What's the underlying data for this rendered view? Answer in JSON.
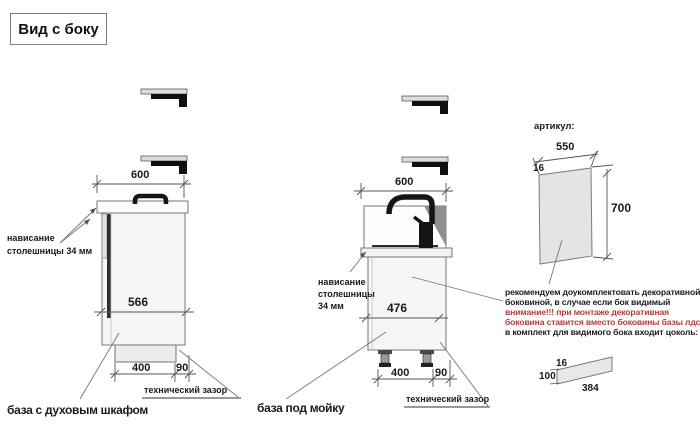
{
  "title": "Вид с боку",
  "colors": {
    "warning_text": "#b23b3b"
  },
  "oven_base": {
    "caption": "база с духовым шкафом",
    "dims": {
      "width": "600",
      "depth": "566",
      "plinth": "400",
      "gap": "90"
    },
    "gap_label": "технический зазор",
    "overhang": {
      "line1": "нависание",
      "line2": "столешницы 34 мм"
    }
  },
  "sink_base": {
    "caption": "база под мойку",
    "dims": {
      "width": "600",
      "depth": "476",
      "plinth": "400",
      "gap": "90"
    },
    "gap_label": "технический зазор",
    "overhang": {
      "line1": "нависание",
      "line2": "столешницы",
      "line3": "34 мм"
    }
  },
  "decor_panel": {
    "heading": "артикул:",
    "dims": {
      "width": "550",
      "thickness": "16",
      "height": "700"
    },
    "note": {
      "lines": [
        {
          "text": "рекомендуем доукомплектовать декоративной",
          "warning": false
        },
        {
          "text": "боковиной, в случае если бок видимый",
          "warning": false
        },
        {
          "text": "внимание!!! при монтаже декоративная",
          "warning": true
        },
        {
          "text": "боковина ставится вместо боковины базы лдсп",
          "warning": true
        },
        {
          "text": "в комплект для видимого бока входит цоколь:",
          "warning": false
        }
      ]
    }
  },
  "plinth_panel": {
    "dims": {
      "thickness": "16",
      "height": "100",
      "length": "384"
    }
  }
}
